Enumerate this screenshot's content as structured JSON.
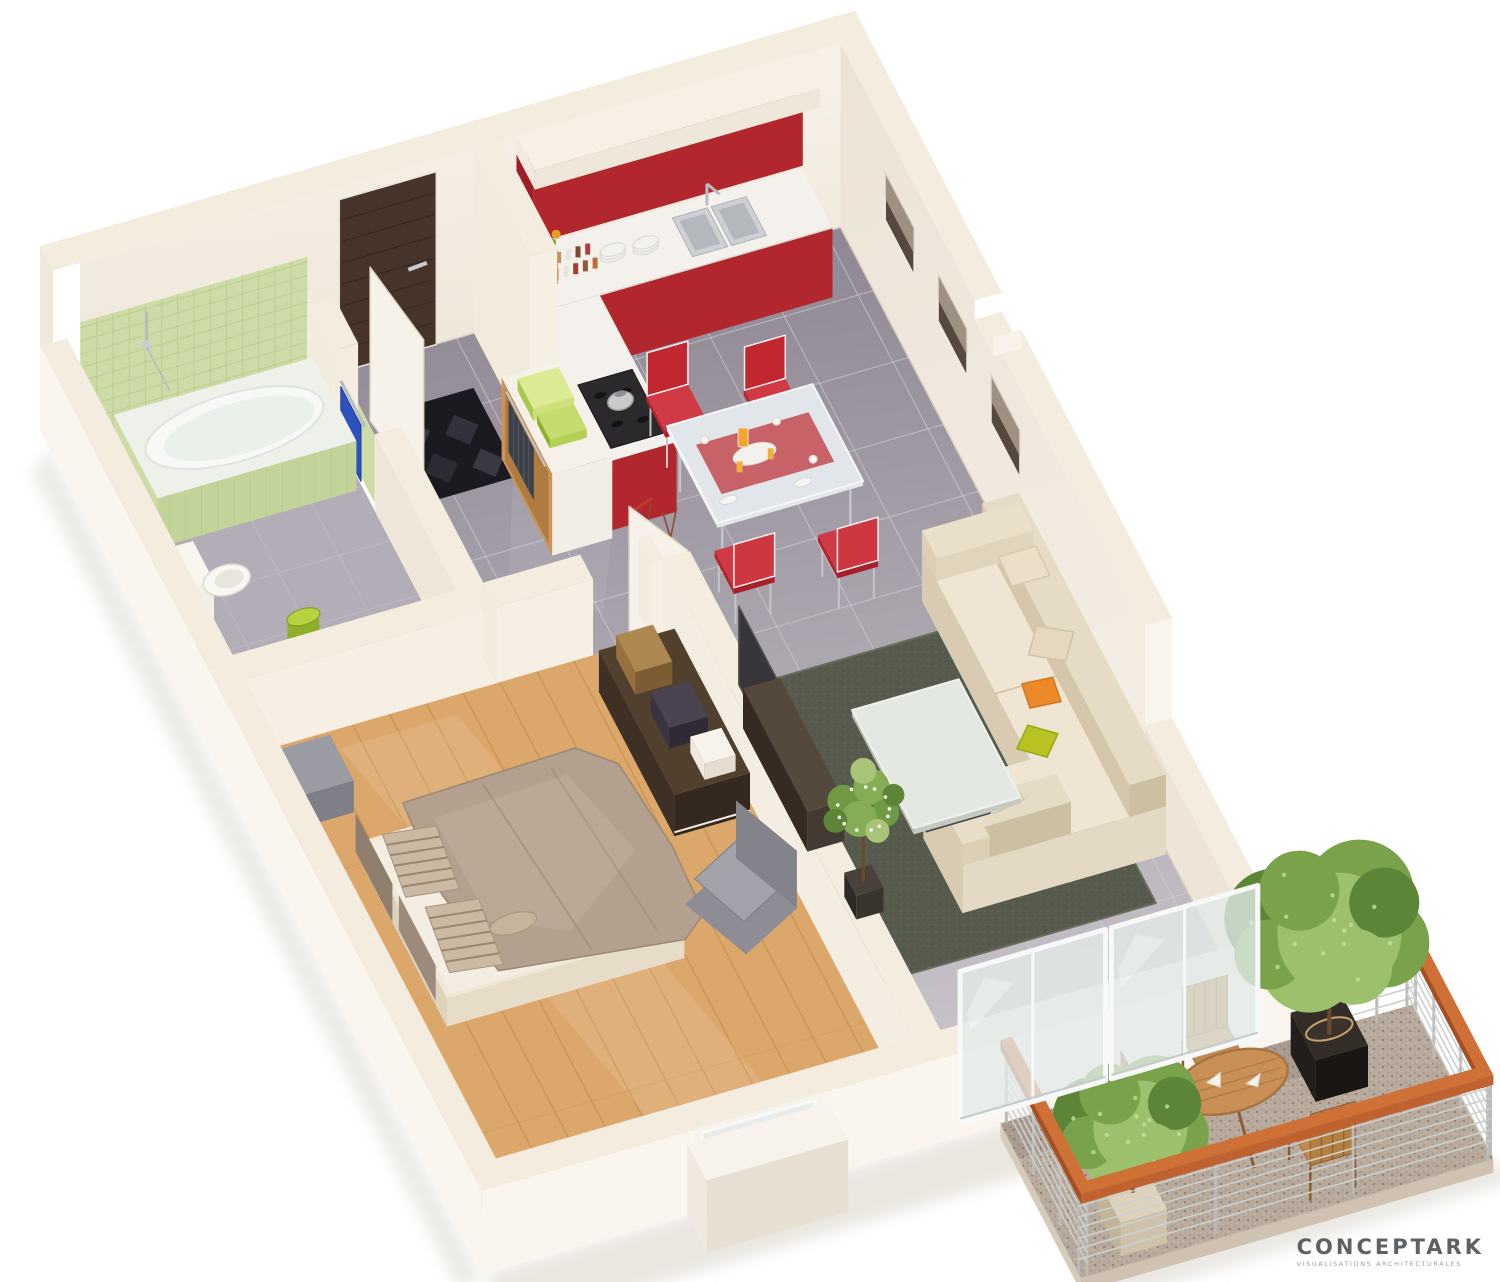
{
  "branding": {
    "logo": "CONCEPTARK",
    "tagline": "VISUALISATIONS ARCHITECTURALES"
  },
  "scene": {
    "type": "isometric-3d-floor-plan",
    "rooms": [
      "entry-hall",
      "kitchen",
      "dining-area",
      "living-room",
      "bedroom",
      "bathroom",
      "balcony"
    ]
  },
  "palette": {
    "wall_bright": "#faf6ef",
    "wall_top": "#f4ecdf",
    "wall_face": "#f2ebe0",
    "wall_shade": "#eae1d2",
    "floor_dark": "#8f8894",
    "floor_light": "#ccc7cd",
    "grout": "#d9d5dc",
    "floor_bath": "#b2adb6",
    "wood": "#dca76a",
    "wood_line": "#b47e3c",
    "rug": "#575b4d",
    "mat": "#1a1a20",
    "door": "#46342a",
    "tile_green": "#cddca6",
    "tile_grout": "#b7cb8c",
    "red": "#b2262e",
    "red_dark": "#9e1d26",
    "counter": "#f4f1ec",
    "chair_red": "#c1272f",
    "sofa": "#e6dcc6",
    "sofa_shade": "#d5c8ad",
    "pillow_orange": "#ec8a2a",
    "pillow_green": "#b8c323",
    "duvet": "#b3a08e",
    "glass": "#e3ebe9",
    "rail_wood": "#c0622f",
    "steel": "#b9bcb8",
    "cable": "#cdd0cc",
    "gravel": "#b7a99c",
    "tree": "#7aa24a",
    "tree_dark": "#5d8537",
    "tree_light": "#9cc06b",
    "pot_dark": "#26221f",
    "shadow": "#d8d2c7"
  }
}
